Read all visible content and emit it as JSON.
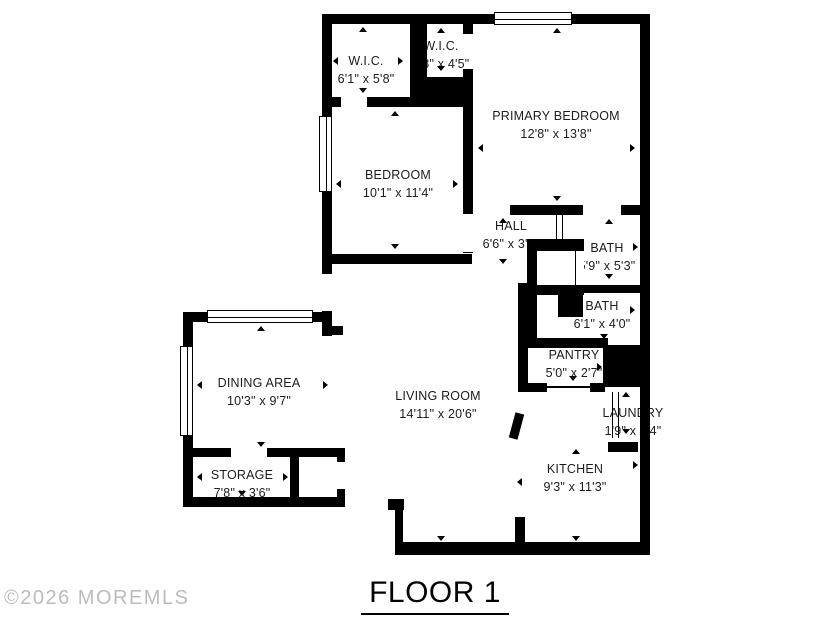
{
  "title": "FLOOR 1",
  "watermark": "©2026 MOREMLS",
  "floor": {
    "wall_color": "#000000",
    "background": "#ffffff",
    "watermark_color": "#bcbcbc",
    "rooms": [
      {
        "id": "wic-1",
        "name": "W.I.C.",
        "dims": "6'1\" x 5'8\""
      },
      {
        "id": "wic-2",
        "name": "W.I.C.",
        "dims": "3'8\" x 4'5\""
      },
      {
        "id": "primary-bedroom",
        "name": "PRIMARY BEDROOM",
        "dims": "12'8\" x 13'8\""
      },
      {
        "id": "bedroom",
        "name": "BEDROOM",
        "dims": "10'1\" x 11'4\""
      },
      {
        "id": "hall",
        "name": "HALL",
        "dims": "6'6\" x 3'8\""
      },
      {
        "id": "bath-1",
        "name": "BATH",
        "dims": "5'9\" x 5'3\""
      },
      {
        "id": "bath-2",
        "name": "BATH",
        "dims": "6'1\" x 4'0\""
      },
      {
        "id": "pantry",
        "name": "PANTRY",
        "dims": "5'0\" x 2'7\""
      },
      {
        "id": "laundry",
        "name": "LAUNDRY",
        "dims": "1'9\" x 4'4\""
      },
      {
        "id": "dining-area",
        "name": "DINING AREA",
        "dims": "10'3\" x 9'7\""
      },
      {
        "id": "living-room",
        "name": "LIVING ROOM",
        "dims": "14'11\" x 20'6\""
      },
      {
        "id": "kitchen",
        "name": "KITCHEN",
        "dims": "9'3\" x 11'3\""
      },
      {
        "id": "storage",
        "name": "STORAGE",
        "dims": "7'8\" x 3'6\""
      }
    ]
  }
}
